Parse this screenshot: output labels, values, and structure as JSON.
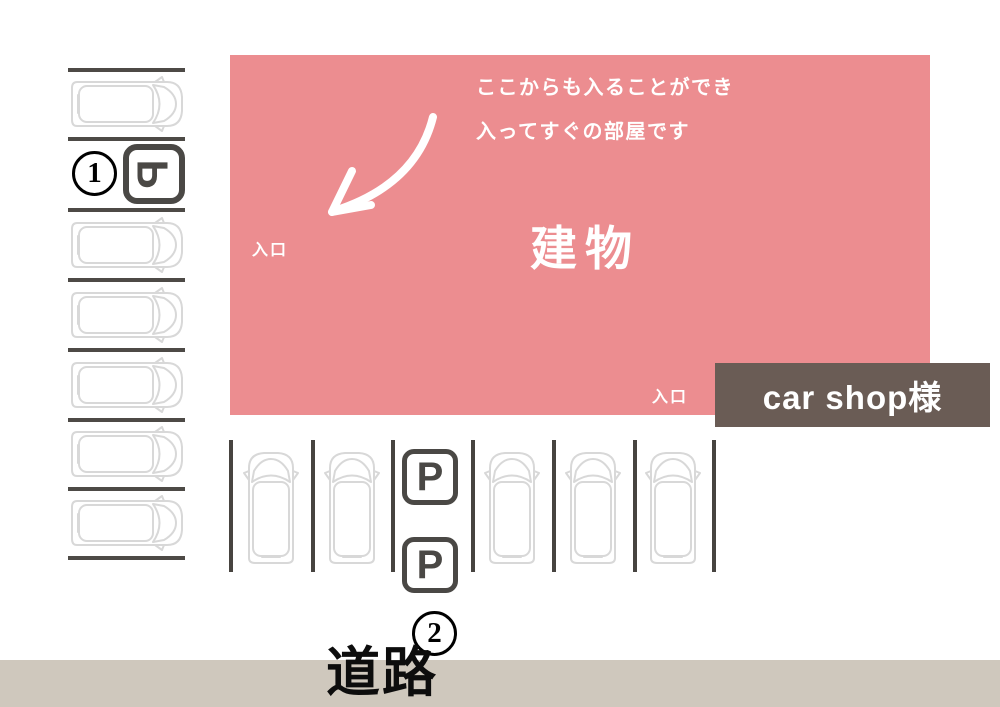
{
  "diagram": {
    "building": {
      "title": "建物",
      "annotation_line1": "ここからも入ることができ",
      "annotation_line2": "入ってすぐの部屋です",
      "entrance_left_label": "入口",
      "entrance_bottom_label": "入口"
    },
    "car_shop_box": {
      "label": "car shop様"
    },
    "road": {
      "label": "道路"
    },
    "parking": {
      "p_sign_label": "P",
      "spot1_number": "1",
      "spot2_number": "2"
    },
    "colors": {
      "building_pink": "#ec8d90",
      "sign_dark": "#4a4845",
      "car_shop_bg": "#6a5c55",
      "road_bg": "#cfc8bd",
      "car_outline": "#d8d8d8"
    }
  }
}
